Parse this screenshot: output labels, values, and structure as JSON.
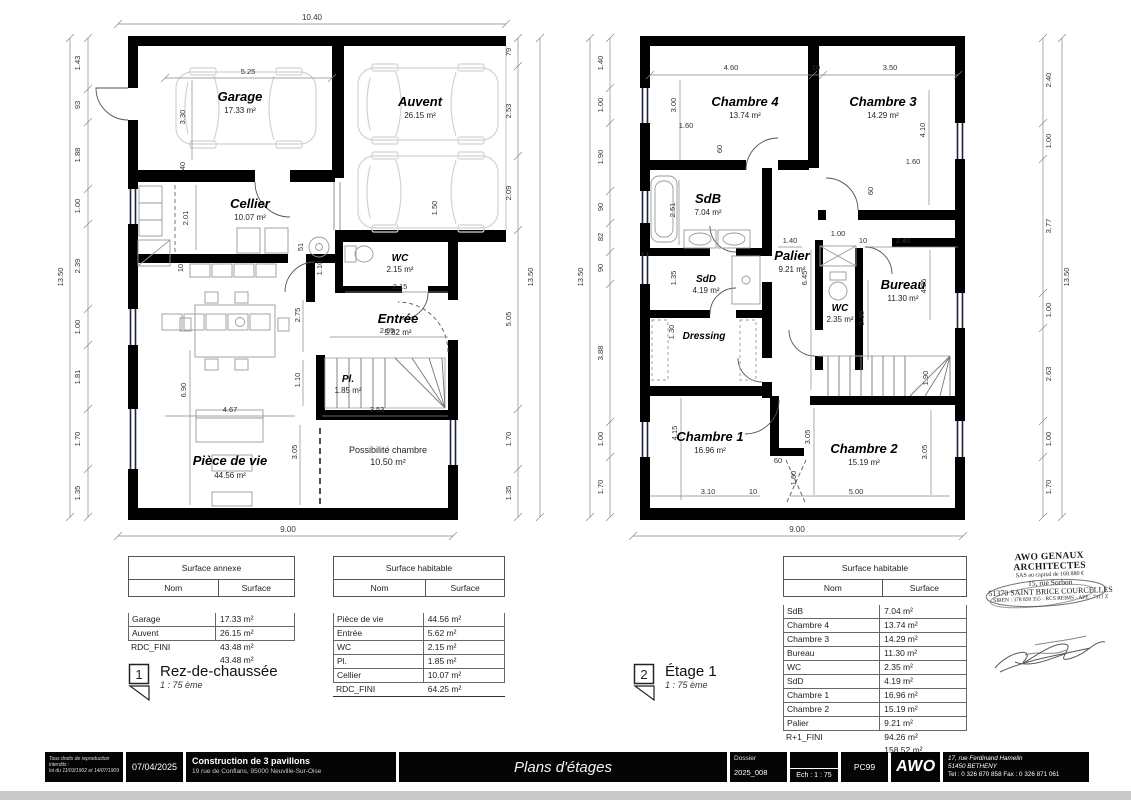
{
  "plans": {
    "rdc": {
      "marker": {
        "num": "1",
        "title": "Rez-de-chaussée",
        "scale": "1 : 75 ème"
      },
      "rooms": {
        "garage": {
          "name": "Garage",
          "area": "17.33 m²"
        },
        "auvent": {
          "name": "Auvent",
          "area": "26.15 m²"
        },
        "cellier": {
          "name": "Cellier",
          "area": "10.07 m²"
        },
        "wc": {
          "name": "WC",
          "area": "2.15 m²"
        },
        "entree": {
          "name": "Entrée",
          "area": "5.82 m²"
        },
        "piece_de_vie": {
          "name": "Pièce de vie",
          "area": "44.56 m²"
        },
        "placard": {
          "name": "Pl.",
          "area": "1.85 m²"
        },
        "possibilite": {
          "name": "Possibilité chambre",
          "area": "10.50 m²"
        }
      },
      "dims": {
        "top": "10.40",
        "bottom": "9.00",
        "total_left": "13.50",
        "total_right": "13.50",
        "left": [
          "1.43",
          "93",
          "1.88",
          "1.00",
          "2.39",
          "1.00",
          "1.81",
          "1.70",
          "1.35"
        ],
        "right": [
          "79",
          "2.53",
          "2.09",
          "5.05",
          "1.70",
          "1.35"
        ],
        "inner": [
          "5.25",
          "3.30",
          "40",
          "2.01",
          "1.50",
          "51",
          "10",
          "1.10",
          "2.75",
          "2.15",
          "2.95",
          "1.10",
          "6.90",
          "4.67",
          "3.53",
          "3.05"
        ]
      }
    },
    "etage": {
      "marker": {
        "num": "2",
        "title": "Étage 1",
        "scale": "1 : 75 ème"
      },
      "rooms": {
        "chambre4": {
          "name": "Chambre 4",
          "area": "13.74 m²"
        },
        "chambre3": {
          "name": "Chambre 3",
          "area": "14.29 m²"
        },
        "sdb": {
          "name": "SdB",
          "area": "7.04 m²"
        },
        "sdd": {
          "name": "SdD",
          "area": "4.19 m²"
        },
        "palier": {
          "name": "Palier",
          "area": "9.21 m²"
        },
        "wc": {
          "name": "WC",
          "area": "2.35 m²"
        },
        "bureau": {
          "name": "Bureau",
          "area": "11.30 m²"
        },
        "dressing": {
          "name": "Dressing"
        },
        "chambre1": {
          "name": "Chambre 1",
          "area": "16.96 m²"
        },
        "chambre2": {
          "name": "Chambre 2",
          "area": "15.19 m²"
        }
      },
      "dims": {
        "bottom": "9.00",
        "total_left": "13.50",
        "total_right": "13.50",
        "left": [
          "1.40",
          "1.00",
          "1.90",
          "90",
          "82",
          "90",
          "3.88",
          "1.00",
          "1.70"
        ],
        "right": [
          "2.40",
          "1.00",
          "3.77",
          "1.00",
          "2.63",
          "1.00",
          "1.70"
        ],
        "inner": [
          "4.60",
          "10",
          "3.50",
          "3.00",
          "1.60",
          "60",
          "4.10",
          "1.60",
          "60",
          "2.51",
          "1.40",
          "1.00",
          "10",
          "2.40",
          "6.45",
          "1.35",
          "2.35",
          "4.25",
          "1.30",
          "1.90",
          "4.15",
          "3.05",
          "3.05",
          "60",
          "1.60",
          "3.10",
          "10",
          "5.00"
        ]
      }
    }
  },
  "tables": {
    "annexe": {
      "title": "Surface annexe",
      "col_nom": "Nom",
      "col_surface": "Surface",
      "rows": [
        {
          "nom": "Garage",
          "surface": "17.33 m²"
        },
        {
          "nom": "Auvent",
          "surface": "26.15 m²"
        }
      ],
      "totals": [
        {
          "nom": "RDC_FINI",
          "surface": "43.48 m²"
        },
        {
          "nom": "",
          "surface": "43.48 m²"
        }
      ]
    },
    "habitable_rdc": {
      "title": "Surface habitable",
      "col_nom": "Nom",
      "col_surface": "Surface",
      "rows": [
        {
          "nom": "Pièce de vie",
          "surface": "44.56 m²"
        },
        {
          "nom": "Entrée",
          "surface": "5.62 m²"
        },
        {
          "nom": "WC",
          "surface": "2.15 m²"
        },
        {
          "nom": "Pl.",
          "surface": "1.85 m²"
        },
        {
          "nom": "Cellier",
          "surface": "10.07 m²"
        }
      ],
      "totals": [
        {
          "nom": "RDC_FINI",
          "surface": "64.25 m²"
        }
      ]
    },
    "habitable_etage": {
      "title": "Surface habitable",
      "col_nom": "Nom",
      "col_surface": "Surface",
      "rows": [
        {
          "nom": "SdB",
          "surface": "7.04 m²"
        },
        {
          "nom": "Chambre 4",
          "surface": "13.74 m²"
        },
        {
          "nom": "Chambre 3",
          "surface": "14.29 m²"
        },
        {
          "nom": "Bureau",
          "surface": "11.30 m²"
        },
        {
          "nom": "WC",
          "surface": "2.35 m²"
        },
        {
          "nom": "SdD",
          "surface": "4.19 m²"
        },
        {
          "nom": "Chambre 1",
          "surface": "16.96 m²"
        },
        {
          "nom": "Chambre 2",
          "surface": "15.19 m²"
        },
        {
          "nom": "Palier",
          "surface": "9.21 m²"
        }
      ],
      "totals": [
        {
          "nom": "R+1_FINI",
          "surface": "94.26 m²"
        },
        {
          "nom": "",
          "surface": "158.52 m²"
        }
      ]
    }
  },
  "stamp": {
    "line1": "AWO GENAUX ARCHITECTES",
    "line2": "SAS au capital de 168.880 €",
    "line3": "15, rue Sorbon",
    "line4": "51370 SAINT BRICE COURCELLES",
    "line5": "SIREN : 378 850 355 - RCS REIMS - APE : 7111 Z"
  },
  "footer": {
    "copyright1": "Tous droits de reproduction interdits :",
    "copyright2": "loi du 11/03/1902 et 14/07/1909",
    "date": "07/04/2025",
    "project_title": "Construction de 3 pavillons",
    "project_address": "19 rue de Conflans, 95000 Neuville-Sur-Oise",
    "sheet_title": "Plans d'étages",
    "dossier_label": "Dossier",
    "dossier_value": "2025_008",
    "scale_label": "Ech : 1 : 75",
    "code": "PC99",
    "logo": "AWO",
    "address1": "17, rue Ferdinand Hamelin",
    "address2": "51450 BETHENY",
    "address3": "Tel : 0 326 870 858 Fax : 0 326 871 061"
  }
}
